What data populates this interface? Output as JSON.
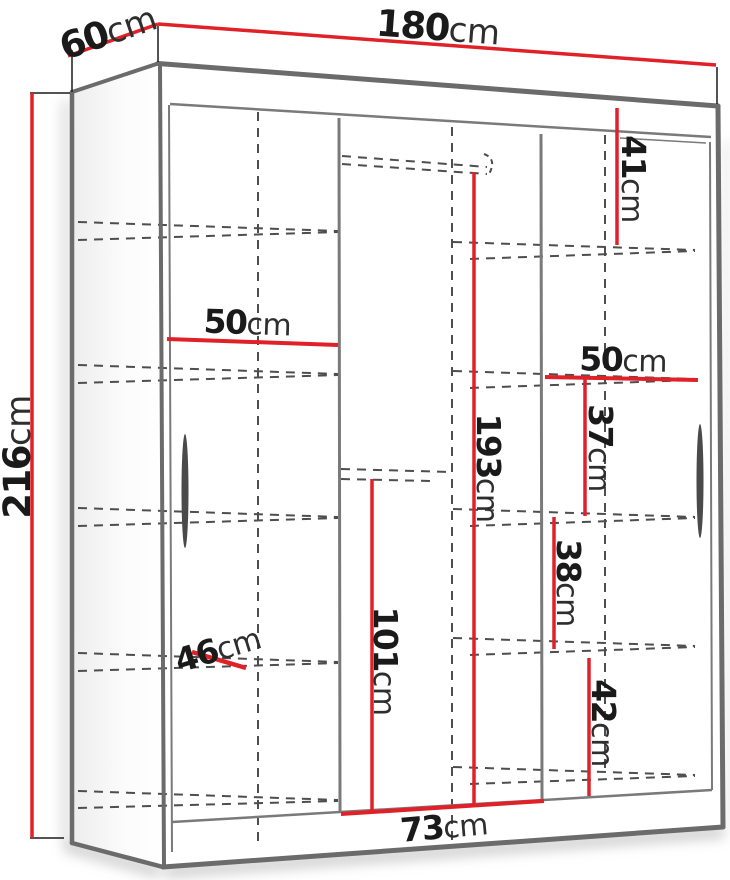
{
  "diagram": {
    "kind": "wardrobe-dimension-diagram",
    "unit": "cm",
    "colors": {
      "dimension_red": "#e02128",
      "outline_gray": "#6b6b6b",
      "hidden_line_gray": "#4e4e4e",
      "text_black": "#1a1a1a",
      "background": "#ffffff"
    },
    "overall": {
      "width": {
        "value": "180",
        "unit": "cm"
      },
      "depth": {
        "value": "60",
        "unit": "cm"
      },
      "height": {
        "value": "216",
        "unit": "cm"
      }
    },
    "interior": {
      "interior_height": {
        "value": "193",
        "unit": "cm"
      },
      "top_right_section_height": {
        "value": "41",
        "unit": "cm"
      },
      "left_compartment_width": {
        "value": "50",
        "unit": "cm"
      },
      "right_compartment_width": {
        "value": "50",
        "unit": "cm"
      },
      "right_section1_height": {
        "value": "37",
        "unit": "cm"
      },
      "right_section2_height": {
        "value": "38",
        "unit": "cm"
      },
      "right_section3_height": {
        "value": "42",
        "unit": "cm"
      },
      "middle_lower_section_height": {
        "value": "101",
        "unit": "cm"
      },
      "middle_compartment_width": {
        "value": "73",
        "unit": "cm"
      },
      "shelf_depth": {
        "value": "46",
        "unit": "cm"
      }
    }
  }
}
